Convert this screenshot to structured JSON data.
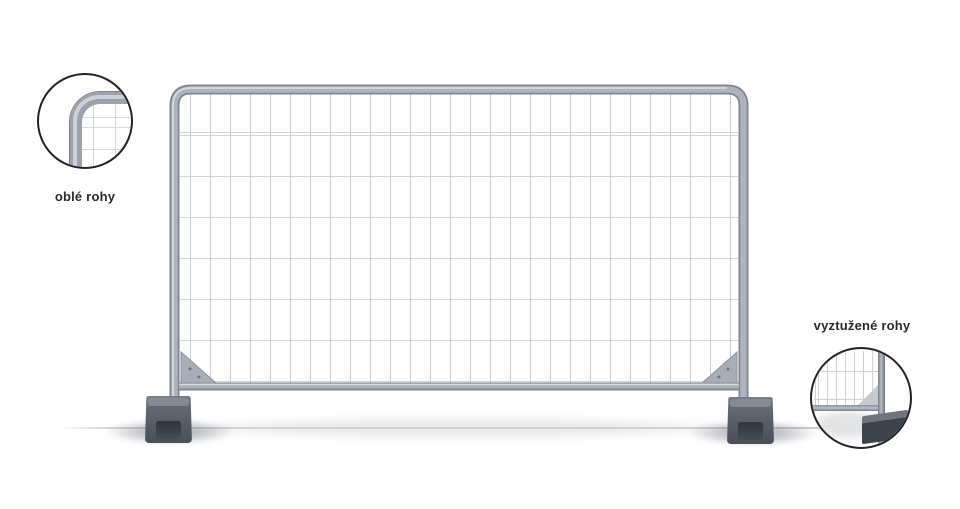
{
  "image": {
    "description": "Mobile construction fence panel product render with two detail callouts",
    "background_color": "#ffffff"
  },
  "fence": {
    "frame_edge_color": "#7e8692",
    "frame_tube_color": "#adb4bd",
    "frame_highlight_color": "#d6dade",
    "mesh_vertical_line_color": "#c7ccd2",
    "mesh_horizontal_line_color": "#d2d6da",
    "gusset_color": "#a8aeb7",
    "foot_color": "#575d66",
    "foot_recess_color": "#3a3f46",
    "ground_shadow_color": "#d6d6d6"
  },
  "callouts": {
    "left": {
      "label": "oblé rohy"
    },
    "right": {
      "label": "vyztužené rohy"
    }
  }
}
